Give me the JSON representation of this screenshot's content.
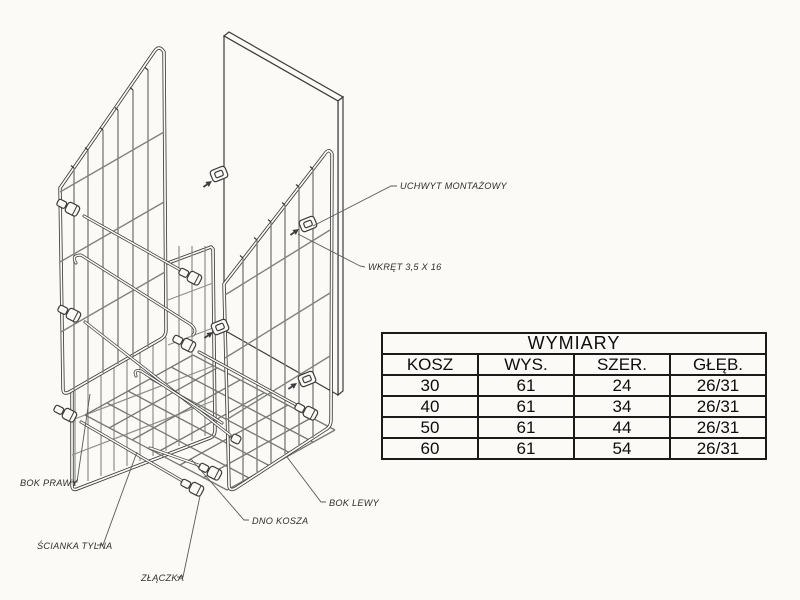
{
  "drawing": {
    "labels": {
      "uchwyt_montazowy": "UCHWYT MONTAŻOWY",
      "wkret": "WKRĘT 3,5 X 16",
      "bok_prawy": "BOK PRAWY",
      "scianka_tylna": "ŚCIANKA TYLNA",
      "zlaczka": "ZŁĄCZKA",
      "dno_kosza": "DNO KOSZA",
      "bok_lewy": "BOK LEWY"
    },
    "colors": {
      "line": "#3c3c3c",
      "wire": "#82827d",
      "background": "#fbfaf7",
      "table_border": "#1b1b1b"
    }
  },
  "dimensions_table": {
    "title": "WYMIARY",
    "columns": [
      "KOSZ",
      "WYS.",
      "SZER.",
      "GŁĘB."
    ],
    "rows": [
      [
        "30",
        "61",
        "24",
        "26/31"
      ],
      [
        "40",
        "61",
        "34",
        "26/31"
      ],
      [
        "50",
        "61",
        "44",
        "26/31"
      ],
      [
        "60",
        "61",
        "54",
        "26/31"
      ]
    ]
  }
}
